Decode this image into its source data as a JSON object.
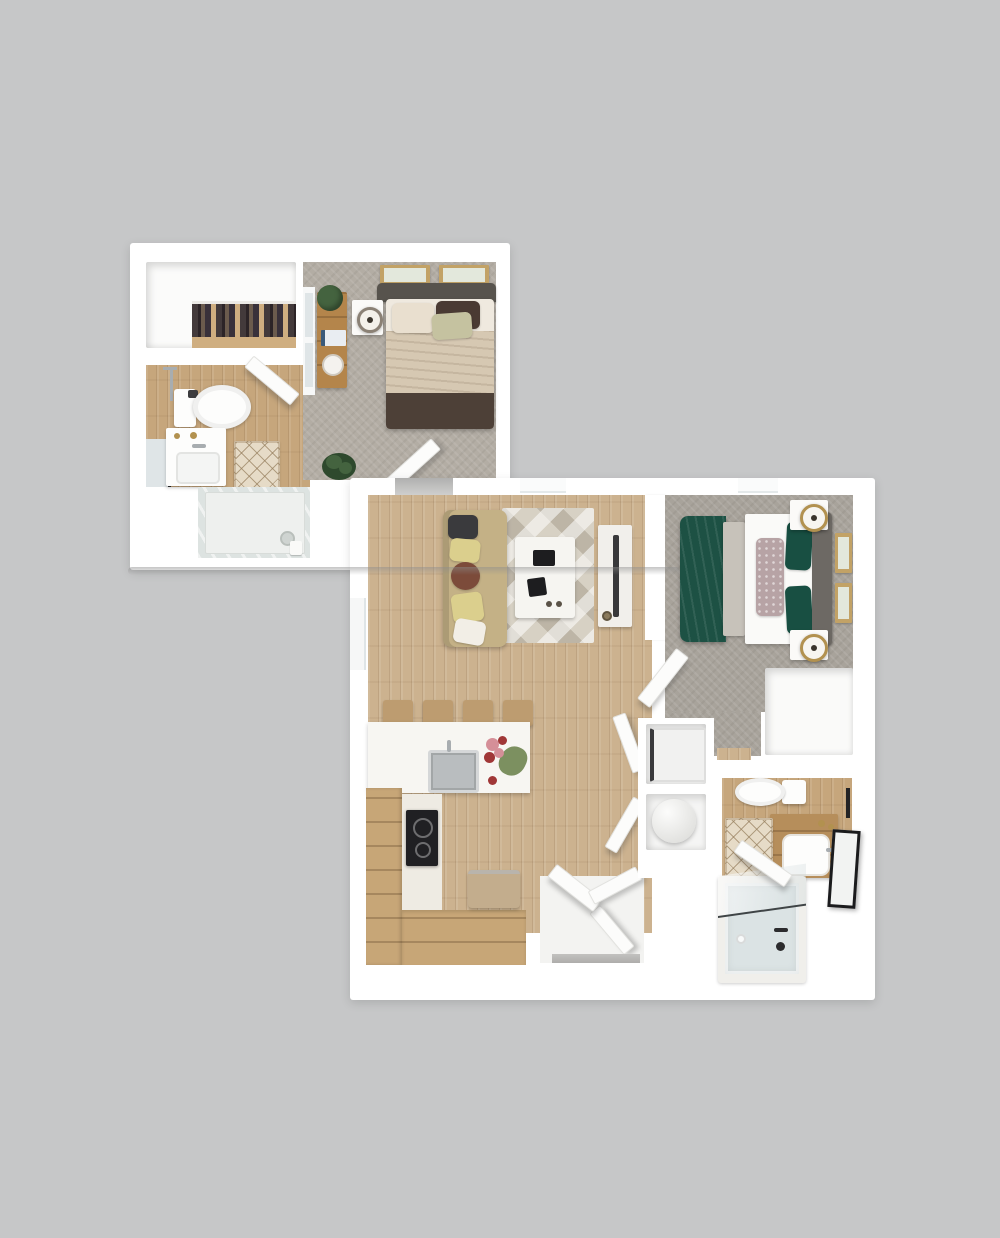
{
  "palette": {
    "background": "#c6c7c8",
    "wall": "#ffffff",
    "livingWood": "#ccb28f",
    "bathWood": "#c6a67c",
    "kitchenTile": "#eeebe3",
    "carpetA": "#b3ada4",
    "carpetB": "#a8a39b",
    "entryFloor": "#f3f3f1",
    "counter": "#f7f6f2",
    "cabinetWood": "#c7a677",
    "stoolWood": "#bd9c70",
    "stove": "#202023",
    "sinkSteel": "#b9bdbf",
    "benchTan": "#c3ad8d",
    "flowerPink": "#d58f98",
    "flowerRed": "#a03737",
    "leafGreen": "#7c9060",
    "sofa": "#c4b186",
    "pillowDark": "#3a3a3d",
    "pillowYellow": "#dbcf8d",
    "pillowBrown": "#7c4b3a",
    "pillowWhite": "#f2eee6",
    "rugBase": "#d7d1c4",
    "coffeeTable": "#f6f5f1",
    "remoteBlack": "#1d1d1f",
    "tvConsole": "#f1efeb",
    "tvBlack": "#38383a",
    "blanketBeige": "#d6c8b2",
    "bedFoot": "#4d4037",
    "headboardA": "#57534d",
    "pillowCream": "#e9dfcf",
    "pillowCocoa": "#4a3a33",
    "pillowSage": "#c5c2a0",
    "nightstand": "#fbfaf8",
    "lampGold": "#b2914f",
    "consoleWood": "#b4854b",
    "plantGreen": "#44633f",
    "plantDark": "#2e492d",
    "clothesWood": "#cfae80",
    "duvetGreen": "#1d5144",
    "bedWhite": "#fafaf8",
    "headboardB": "#6d6964",
    "footBench": "#c7c2ba",
    "lumbarFloral": "#b7a3a5",
    "pillowGreen": "#184f42",
    "frameTan": "#c2a266",
    "frameArt": "#e3e8dc",
    "washer": "#f1f1f0",
    "heater": "#efefed",
    "vanityWood": "#b68e5b",
    "porcelain": "#fdfdfc",
    "mirrorBlack": "#1b1b1d",
    "towelBlack": "#232325",
    "latticeBase": "#e6dbc7",
    "tubRim": "#f0efeb",
    "tubBlue": "#dbe3e4",
    "showerGlass": "#dde3e1",
    "doorWhite": "#fcfcfb",
    "thresholdGray": "#b4b3b1",
    "windowPane": "#dfe5e7",
    "steelChrome": "#a8adb0",
    "bookBlue": "#3a5a7a"
  },
  "rooms": {
    "upper_unit": {
      "walk_in_closet": [
        "clothes-rack"
      ],
      "bathroom": [
        "toilet",
        "vanity-sink",
        "glass-shower",
        "bath-rug",
        "open-door"
      ],
      "bedroom": [
        "bed",
        "headboard",
        "pillows",
        "nightstand",
        "table-lamp",
        "console-table",
        "potted-plant",
        "books",
        "decor-tray",
        "floor-plant",
        "wall-art",
        "wall-art",
        "window",
        "open-door"
      ]
    },
    "lower_unit": {
      "living_room": [
        "sofa",
        "throw-pillows",
        "area-rug",
        "coffee-table",
        "remote",
        "tv-console",
        "tv",
        "window"
      ],
      "kitchen": [
        "bar-stools",
        "island-counter",
        "sink",
        "faucet",
        "flowers",
        "cooktop",
        "cabinets",
        "bench"
      ],
      "bedroom": [
        "bed",
        "green-duvet",
        "foot-bench",
        "lumbar-pillow",
        "green-pillows",
        "headboard",
        "nightstands",
        "table-lamps",
        "wall-art",
        "wall-art",
        "closet",
        "open-door",
        "window"
      ],
      "bathroom": [
        "toilet",
        "vanity-sink",
        "mirror",
        "towel-bar",
        "bath-rug",
        "bathtub",
        "glass-screen",
        "open-door"
      ],
      "utility": [
        "washer",
        "water-heater"
      ],
      "entry": [
        "entry-doors",
        "closet-door",
        "threshold"
      ]
    }
  },
  "counts": {
    "bar_stools": 4,
    "bedrooms": 2,
    "bathrooms": 2,
    "wall_art_total": 4
  }
}
